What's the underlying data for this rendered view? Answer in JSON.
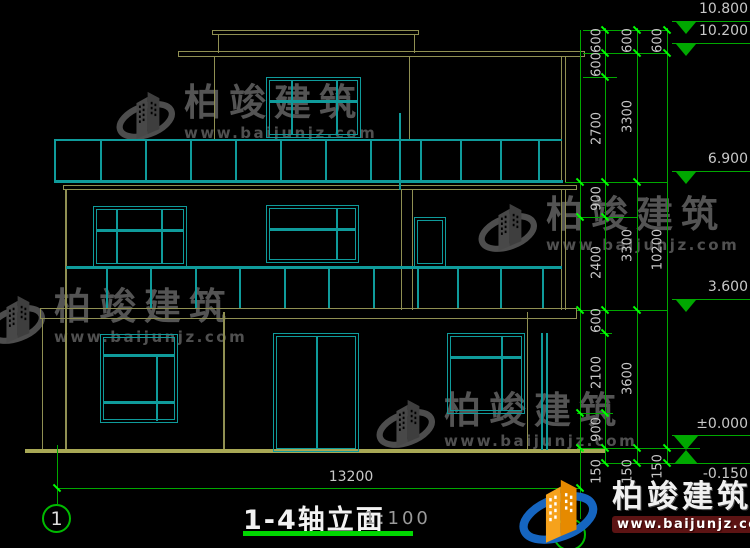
{
  "title": {
    "text": "1-4轴立面",
    "scale": "1:100"
  },
  "axes": {
    "left": "1"
  },
  "dimensions": {
    "bottom": "13200",
    "chain_inner": [
      "600",
      "600",
      "2700",
      "900",
      "2400",
      "600",
      "2100",
      "900",
      "150"
    ],
    "chain_middle": [
      "600",
      "3300",
      "3300",
      "3600",
      "150"
    ],
    "chain_outer": [
      "600",
      "10200",
      "150"
    ]
  },
  "elevation_markers": [
    "10.800",
    "10.200",
    "6.900",
    "3.600",
    "±0.000",
    "-0.150"
  ],
  "watermark": {
    "brand": "柏竣建筑",
    "url": "www.baijunjz.com"
  },
  "logo": {
    "brand": "柏竣建筑",
    "url": "www.baijunjz.com"
  },
  "colors": {
    "line_teal": "#0f9b9b",
    "line_olive": "#8f8f52",
    "ground": "#a8a855",
    "dim_green": "#00a800",
    "tick_green": "#00ff00",
    "accent_green": "#00d800",
    "text_gray": "#c8c8c8",
    "logo_blue": "#1565c0",
    "logo_orange": "#f6a21c"
  }
}
